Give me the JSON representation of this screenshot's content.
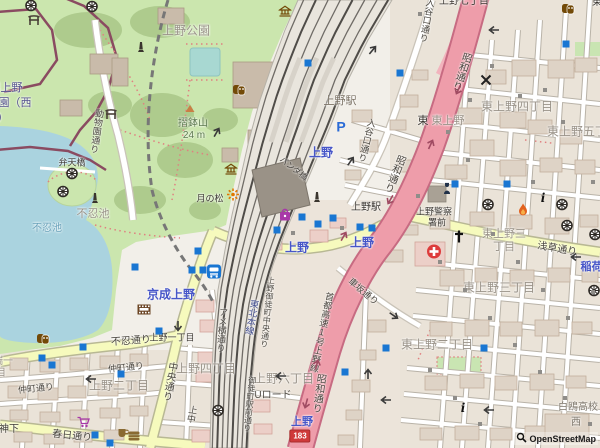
{
  "attribution": {
    "text": "OpenStreetMap"
  },
  "theme": {
    "station_blue": "#4756c8",
    "district_grey": "#9a9389",
    "road_dark": "#4a463f",
    "nature_green": "#5e7a50",
    "water_blue": "#6aa2ba",
    "junction_dark": "#3c3833",
    "zoo_purple": "#54508e",
    "school_grey": "#7c756a",
    "rail_blue": "#3f4a8c",
    "station_bldg": "#7b7265",
    "shield_red": "#cf3a3a",
    "motorway_pink": "#ee9daa",
    "park_green": "#cbe6ae",
    "water_fill": "#aad3df",
    "subway_entrance_blue": "#1976d2"
  },
  "route_shield": {
    "text": "183",
    "x": 300,
    "y": 436
  },
  "map": {
    "labels": [
      {
        "name": "ueno-park",
        "text": "上野公園",
        "x": 186,
        "y": 31,
        "c": "district_grey",
        "s": 12
      },
      {
        "name": "suribachiyama",
        "text": "摺鉢山",
        "x": 193,
        "y": 124,
        "c": "nature_green",
        "s": 10
      },
      {
        "name": "suribachiyama-elev",
        "text": "24 m",
        "x": 194,
        "y": 136,
        "c": "nature_green",
        "s": 10
      },
      {
        "name": "tsuki-no-matsu",
        "text": "月の松",
        "x": 210,
        "y": 199,
        "c": "junction_dark",
        "s": 9
      },
      {
        "name": "bentenbashi",
        "text": "弁天橋",
        "x": 72,
        "y": 163,
        "c": "junction_dark",
        "s": 9
      },
      {
        "name": "shinobazu-pond-place",
        "text": "不忍池",
        "x": 93,
        "y": 215,
        "c": "district_grey",
        "s": 11
      },
      {
        "name": "shinobazu-pond-water",
        "text": "不忍池",
        "x": 47,
        "y": 229,
        "c": "water_blue",
        "s": 10
      },
      {
        "name": "zoo-name-line1",
        "text": "賜上野",
        "x": 6,
        "y": 89,
        "c": "zoo_purple",
        "s": 11
      },
      {
        "name": "zoo-name-line2",
        "text": "園（西",
        "x": 15,
        "y": 104,
        "c": "zoo_purple",
        "s": 11
      },
      {
        "name": "zoo-name-line3",
        "text": "）",
        "x": 3,
        "y": 119,
        "c": "zoo_purple",
        "s": 11
      },
      {
        "name": "dobutsuen-dori",
        "text": "動物園通り",
        "x": 96,
        "y": 131,
        "c": "road_dark",
        "s": 9,
        "v": true,
        "r": 8
      },
      {
        "name": "ueno-sta-building",
        "text": "上野駅",
        "x": 340,
        "y": 102,
        "c": "station_bldg",
        "s": 11
      },
      {
        "name": "ueno-jr",
        "text": "上野",
        "x": 321,
        "y": 153,
        "c": "station_blue",
        "s": 12,
        "b": true
      },
      {
        "name": "panda-bashi",
        "text": "パンダ橋",
        "x": 293,
        "y": 169,
        "c": "junction_dark",
        "s": 8,
        "r": 38
      },
      {
        "name": "iriyaguchi-dori-1",
        "text": "入谷口通り",
        "x": 366,
        "y": 140,
        "c": "road_dark",
        "s": 9,
        "v": true,
        "r": 14
      },
      {
        "name": "iriyaguchi-dori-2",
        "text": "入谷口通り",
        "x": 426,
        "y": 20,
        "c": "road_dark",
        "s": 9,
        "v": true,
        "r": 10
      },
      {
        "name": "showa-dori-1",
        "text": "昭和通り",
        "x": 460,
        "y": 71,
        "c": "road_dark",
        "s": 10,
        "v": true,
        "r": 18
      },
      {
        "name": "showa-dori-2",
        "text": "昭和通り",
        "x": 393,
        "y": 173,
        "c": "road_dark",
        "s": 10,
        "v": true,
        "r": 22
      },
      {
        "name": "showa-dori-3",
        "text": "昭和通り",
        "x": 317,
        "y": 393,
        "c": "road_dark",
        "s": 10,
        "v": true,
        "r": 8
      },
      {
        "name": "shuto-expwy-ueno-line",
        "text": "首都高速1号上野線",
        "x": 321,
        "y": 332,
        "c": "road_dark",
        "s": 9,
        "v": true,
        "r": 12
      },
      {
        "name": "higashi-fragment",
        "text": "東",
        "x": 423,
        "y": 122,
        "c": "junction_dark",
        "s": 11
      },
      {
        "name": "higashi-ueno",
        "text": "東上野",
        "x": 448,
        "y": 122,
        "c": "district_grey",
        "s": 11
      },
      {
        "name": "higashi-ueno-4",
        "text": "東上野四丁目",
        "x": 517,
        "y": 107,
        "c": "district_grey",
        "s": 12
      },
      {
        "name": "higashi-ueno-5",
        "text": "東上野五丁目",
        "x": 583,
        "y": 132,
        "c": "district_grey",
        "s": 12
      },
      {
        "name": "higashi-ueno-3-l1",
        "text": "東上野三",
        "x": 504,
        "y": 235,
        "c": "district_grey",
        "s": 11
      },
      {
        "name": "higashi-ueno-3-l2",
        "text": "丁目",
        "x": 504,
        "y": 248,
        "c": "district_grey",
        "s": 11
      },
      {
        "name": "higashi-ueno-3",
        "text": "東上野三丁目",
        "x": 499,
        "y": 288,
        "c": "district_grey",
        "s": 12
      },
      {
        "name": "higashi-ueno-2",
        "text": "東上野二丁目",
        "x": 437,
        "y": 345,
        "c": "district_grey",
        "s": 12
      },
      {
        "name": "asakusa-dori",
        "text": "浅草通り",
        "x": 557,
        "y": 250,
        "c": "road_dark",
        "s": 10,
        "r": 10
      },
      {
        "name": "inaricho",
        "text": "稲荷町",
        "x": 597,
        "y": 268,
        "c": "station_blue",
        "s": 11,
        "b": true
      },
      {
        "name": "kurumazaka-dori",
        "text": "車坂通り",
        "x": 363,
        "y": 292,
        "c": "road_dark",
        "s": 9,
        "r": 40
      },
      {
        "name": "ueno-eki-junction",
        "text": "上野駅",
        "x": 366,
        "y": 208,
        "c": "junction_dark",
        "s": 10
      },
      {
        "name": "ueno-police-l1",
        "text": "上野警察",
        "x": 434,
        "y": 212,
        "c": "junction_dark",
        "s": 9
      },
      {
        "name": "ueno-police-l2",
        "text": "署前",
        "x": 437,
        "y": 223,
        "c": "junction_dark",
        "s": 9
      },
      {
        "name": "ueno-metro-east",
        "text": "上野",
        "x": 362,
        "y": 243,
        "c": "station_blue",
        "s": 12,
        "b": true
      },
      {
        "name": "ueno-metro-west",
        "text": "上野",
        "x": 297,
        "y": 248,
        "c": "station_blue",
        "s": 12,
        "b": true
      },
      {
        "name": "keisei-ueno",
        "text": "京成上野",
        "x": 171,
        "y": 295,
        "c": "station_blue",
        "s": 12,
        "b": true
      },
      {
        "name": "ueno-exit",
        "text": "上野",
        "x": 302,
        "y": 423,
        "c": "station_blue",
        "s": 11,
        "b": true
      },
      {
        "name": "ueno-7",
        "text": "上野七丁目",
        "x": 464,
        "y": 2,
        "c": "junction_dark",
        "s": 10
      },
      {
        "name": "corner-higashi",
        "text": "東",
        "x": 597,
        "y": 3,
        "c": "junction_dark",
        "s": 10
      },
      {
        "name": "shinobazu-dori",
        "text": "不忍通り",
        "x": 131,
        "y": 342,
        "c": "road_dark",
        "s": 10,
        "r": -4
      },
      {
        "name": "ueno-1-junction",
        "text": "上野一丁目",
        "x": 172,
        "y": 338,
        "c": "junction_dark",
        "s": 9
      },
      {
        "name": "nakacho-dori-1",
        "text": "仲町通り",
        "x": 126,
        "y": 368,
        "c": "road_dark",
        "s": 9,
        "r": -6
      },
      {
        "name": "nakacho-dori-2",
        "text": "仲町通り",
        "x": 36,
        "y": 389,
        "c": "road_dark",
        "s": 9,
        "r": -6
      },
      {
        "name": "ueno-2",
        "text": "上野二丁目",
        "x": 119,
        "y": 386,
        "c": "district_grey",
        "s": 12
      },
      {
        "name": "chuo-dori",
        "text": "中央通り",
        "x": 168,
        "y": 381,
        "c": "road_dark",
        "s": 10,
        "v": true,
        "r": 10
      },
      {
        "name": "ueno-4",
        "text": "上野四丁目",
        "x": 206,
        "y": 369,
        "c": "district_grey",
        "s": 12
      },
      {
        "name": "ueno-6",
        "text": "上野六丁目",
        "x": 284,
        "y": 379,
        "c": "district_grey",
        "s": 12
      },
      {
        "name": "u-road",
        "text": "Uロード",
        "x": 273,
        "y": 396,
        "c": "road_dark",
        "s": 10
      },
      {
        "name": "kasuga-dori",
        "text": "春日通り",
        "x": 72,
        "y": 437,
        "c": "road_dark",
        "s": 10,
        "r": 6
      },
      {
        "name": "tenjinshita",
        "text": "天神下",
        "x": 4,
        "y": 430,
        "c": "junction_dark",
        "s": 10
      },
      {
        "name": "ikenohata-frag1",
        "text": "端一",
        "x": 3,
        "y": 362,
        "c": "district_grey",
        "s": 10
      },
      {
        "name": "ikenohata-frag2",
        "text": "目",
        "x": 1,
        "y": 374,
        "c": "district_grey",
        "s": 10
      },
      {
        "name": "ameyoko-dori",
        "text": "アメ横通り",
        "x": 221,
        "y": 330,
        "c": "road_dark",
        "s": 9,
        "v": true,
        "r": 4
      },
      {
        "name": "tohoku-main-line",
        "text": "東北本線",
        "x": 251,
        "y": 317,
        "c": "rail_blue",
        "s": 9,
        "v": true,
        "r": 10
      },
      {
        "name": "okachimachi-ekimae-dori",
        "text": "御徒町駅前通り",
        "x": 249,
        "y": 404,
        "c": "road_dark",
        "s": 8,
        "v": true,
        "r": 6
      },
      {
        "name": "ueno-okachimachi-chuo-dori",
        "text": "上野御徒町中央通り",
        "x": 267,
        "y": 312,
        "c": "road_dark",
        "s": 8,
        "v": true,
        "r": 6
      },
      {
        "name": "uechun",
        "text": "上中",
        "x": 191,
        "y": 414,
        "c": "road_dark",
        "s": 9,
        "v": true,
        "r": 10
      },
      {
        "name": "hakuo-hs",
        "text": "白鴎高校",
        "x": 578,
        "y": 408,
        "c": "school_grey",
        "s": 10
      },
      {
        "name": "hakuo-hs-west",
        "text": "西",
        "x": 576,
        "y": 423,
        "c": "school_grey",
        "s": 10
      }
    ],
    "icons": [
      {
        "name": "torii-icon",
        "t": "torii",
        "x": 34,
        "y": 22
      },
      {
        "name": "torii-icon",
        "t": "torii",
        "x": 111,
        "y": 116
      },
      {
        "name": "dharma-wheel-icon",
        "t": "wheel",
        "x": 31,
        "y": 8
      },
      {
        "name": "dharma-wheel-icon",
        "t": "wheel",
        "x": 92,
        "y": 9
      },
      {
        "name": "dharma-wheel-icon",
        "t": "wheel",
        "x": 72,
        "y": 176
      },
      {
        "name": "dharma-wheel-icon",
        "t": "wheel",
        "x": 63,
        "y": 194
      },
      {
        "name": "dharma-wheel-icon",
        "t": "wheel",
        "x": 488,
        "y": 207
      },
      {
        "name": "dharma-wheel-icon",
        "t": "wheel",
        "x": 562,
        "y": 207
      },
      {
        "name": "dharma-wheel-icon",
        "t": "wheel",
        "x": 567,
        "y": 228
      },
      {
        "name": "dharma-wheel-icon",
        "t": "wheel",
        "x": 595,
        "y": 237
      },
      {
        "name": "dharma-wheel-icon",
        "t": "wheel",
        "x": 594,
        "y": 293
      },
      {
        "name": "dharma-wheel-icon",
        "t": "wheel",
        "x": 218,
        "y": 413
      },
      {
        "name": "museum-icon",
        "t": "museum",
        "x": 285,
        "y": 13
      },
      {
        "name": "museum-icon",
        "t": "museum",
        "x": 231,
        "y": 171
      },
      {
        "name": "theatre-masks-icon",
        "t": "masks",
        "x": 239,
        "y": 92
      },
      {
        "name": "theatre-masks-icon",
        "t": "masks",
        "x": 568,
        "y": 11
      },
      {
        "name": "theatre-masks-icon",
        "t": "masks",
        "x": 43,
        "y": 341
      },
      {
        "name": "monument-icon",
        "t": "monument",
        "x": 141,
        "y": 49
      },
      {
        "name": "monument-icon",
        "t": "monument",
        "x": 95,
        "y": 200
      },
      {
        "name": "statue-icon",
        "t": "monument",
        "x": 317,
        "y": 199
      },
      {
        "name": "peak-icon",
        "t": "peak",
        "x": 190,
        "y": 109
      },
      {
        "name": "viewpoint-icon",
        "t": "viewpoint",
        "x": 233,
        "y": 197
      },
      {
        "name": "hospital-icon",
        "t": "hospital",
        "x": 434,
        "y": 254
      },
      {
        "name": "church-cross-icon",
        "t": "church",
        "x": 459,
        "y": 239
      },
      {
        "name": "fire-station-icon",
        "t": "flame",
        "x": 523,
        "y": 212
      },
      {
        "name": "information-icon",
        "t": "info",
        "x": 543,
        "y": 200
      },
      {
        "name": "information-icon",
        "t": "info",
        "x": 463,
        "y": 410
      },
      {
        "name": "police-icon",
        "t": "police",
        "x": 447,
        "y": 191
      },
      {
        "name": "parking-icon",
        "t": "parking",
        "x": 341,
        "y": 129
      },
      {
        "name": "bus-station-icon",
        "t": "bus",
        "x": 214,
        "y": 274
      },
      {
        "name": "shop-bag-icon",
        "t": "bag",
        "x": 285,
        "y": 217
      },
      {
        "name": "supermarket-cart-icon",
        "t": "cart",
        "x": 84,
        "y": 424
      },
      {
        "name": "fast-food-icon",
        "t": "burger",
        "x": 134,
        "y": 437
      },
      {
        "name": "cafe-icon",
        "t": "cup",
        "x": 123,
        "y": 434
      },
      {
        "name": "cinema-icon",
        "t": "film",
        "x": 144,
        "y": 311
      },
      {
        "name": "level-crossing-icon",
        "t": "crossx",
        "x": 486,
        "y": 82
      }
    ],
    "subway_entrances": [
      [
        308,
        63
      ],
      [
        400,
        73
      ],
      [
        566,
        44
      ],
      [
        455,
        184
      ],
      [
        507,
        184
      ],
      [
        302,
        217
      ],
      [
        318,
        224
      ],
      [
        333,
        218
      ],
      [
        360,
        227
      ],
      [
        372,
        228
      ],
      [
        277,
        230
      ],
      [
        198,
        251
      ],
      [
        192,
        270
      ],
      [
        203,
        270
      ],
      [
        135,
        267
      ],
      [
        83,
        347
      ],
      [
        42,
        358
      ],
      [
        52,
        365
      ],
      [
        121,
        374
      ],
      [
        159,
        331
      ],
      [
        345,
        372
      ],
      [
        386,
        348
      ],
      [
        484,
        348
      ],
      [
        95,
        435
      ],
      [
        110,
        443
      ]
    ],
    "entrance_dots": [
      [
        293,
        233
      ],
      [
        342,
        228
      ],
      [
        420,
        14
      ],
      [
        448,
        132
      ],
      [
        470,
        100
      ],
      [
        492,
        66
      ],
      [
        520,
        96
      ],
      [
        545,
        90
      ],
      [
        563,
        122
      ],
      [
        533,
        182
      ],
      [
        593,
        182
      ],
      [
        468,
        160
      ],
      [
        440,
        262
      ],
      [
        465,
        290
      ],
      [
        490,
        318
      ],
      [
        515,
        345
      ],
      [
        540,
        372
      ],
      [
        565,
        398
      ],
      [
        590,
        424
      ],
      [
        430,
        370
      ],
      [
        455,
        398
      ],
      [
        480,
        424
      ],
      [
        418,
        196
      ],
      [
        593,
        292
      ],
      [
        568,
        318
      ],
      [
        543,
        290
      ],
      [
        518,
        262
      ],
      [
        493,
        234
      ]
    ],
    "oneway_arrows": [
      {
        "x": 374,
        "y": 46,
        "r": -50
      },
      {
        "x": 493,
        "y": 25,
        "r": 180
      },
      {
        "x": 352,
        "y": 157,
        "r": -55
      },
      {
        "x": 575,
        "y": 252,
        "r": 180
      },
      {
        "x": 394,
        "y": 313,
        "r": 35
      },
      {
        "x": 369,
        "y": 369,
        "r": -90
      },
      {
        "x": 385,
        "y": 395,
        "r": 180
      },
      {
        "x": 90,
        "y": 374,
        "r": 180
      },
      {
        "x": 177,
        "y": 323,
        "r": 90
      },
      {
        "x": 488,
        "y": 405,
        "r": 180
      },
      {
        "x": 280,
        "y": 371,
        "r": 180
      },
      {
        "x": 218,
        "y": 128,
        "r": -60
      }
    ],
    "expressway_arrows": [
      {
        "x": 457,
        "y": 86,
        "r": 115
      },
      {
        "x": 432,
        "y": 140,
        "r": -65
      },
      {
        "x": 389,
        "y": 196,
        "r": 120
      },
      {
        "x": 345,
        "y": 232,
        "r": -60
      },
      {
        "x": 318,
        "y": 360,
        "r": -75
      },
      {
        "x": 305,
        "y": 400,
        "r": 105
      }
    ]
  }
}
